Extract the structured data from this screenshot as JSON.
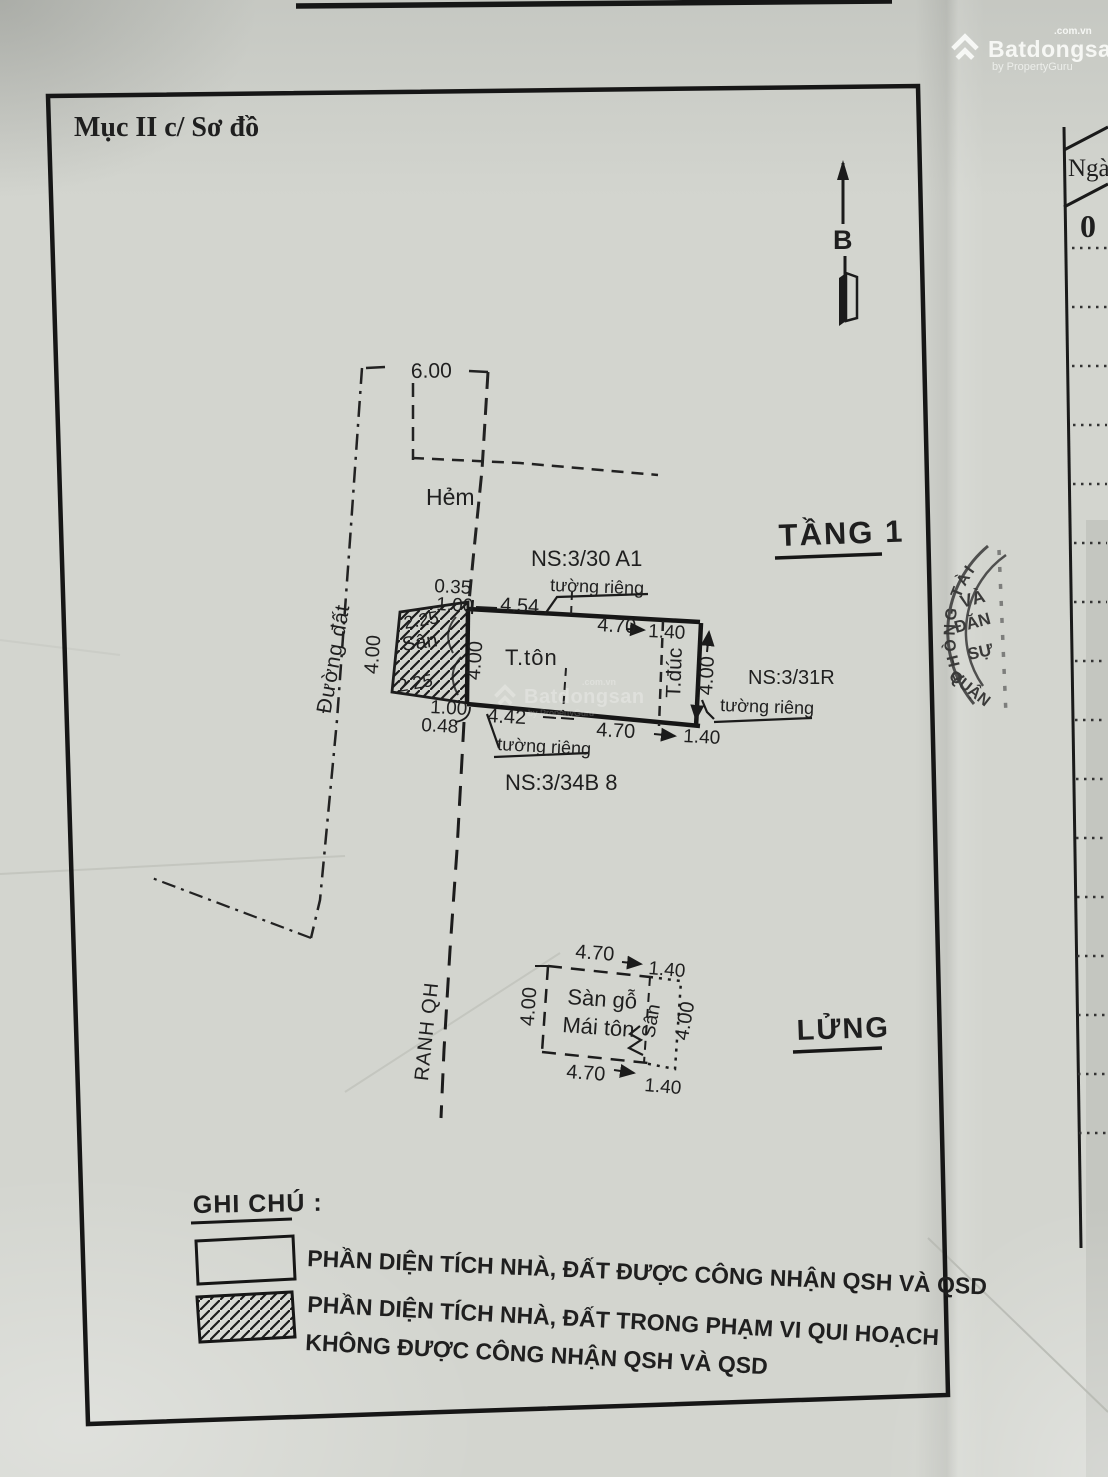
{
  "document": {
    "section_title": "Mục II c/ Sơ đồ"
  },
  "brand": {
    "name": "Batdongsan",
    "tld": ".com.vn",
    "byline": "by PropertyGuru"
  },
  "side_table": {
    "header": "Ngà",
    "digit": "0"
  },
  "compass": {
    "north": "B"
  },
  "floor1": {
    "title": "TẦNG 1",
    "alley": "Hẻm",
    "alley_width": "6.00",
    "road": "Đường đất",
    "boundary": "RANH QH",
    "neighbors": {
      "top": "NS:3/30 A1",
      "right": "NS:3/31R",
      "bottom": "NS:3/34B 8"
    },
    "walls": {
      "top": "tường riêng",
      "right": "tường riêng",
      "bottom": "tường riêng"
    },
    "rooms": {
      "main": "T.tôn",
      "right": "T.đúc",
      "yard": "Sân"
    },
    "dims": {
      "off_top1": "0.35",
      "off_top2": "1.00",
      "top1": "4.54",
      "top2": "4.70",
      "top3": "1.40",
      "left": "4.00",
      "inner_left": "4.00",
      "right": "4.00",
      "yard_top": "2.25",
      "yard_bottom": "2.25",
      "off_bot1": "1.00",
      "off_bot2": "0.48",
      "bot1": "4.42",
      "bot2": "4.70",
      "bot3": "1.40"
    }
  },
  "mezzanine": {
    "title": "LỬNG",
    "room_line1": "Sàn gỗ",
    "room_line2": "Mái tôn",
    "yard": "Sân",
    "dims": {
      "top1": "4.70",
      "top2": "1.40",
      "bot1": "4.70",
      "bot2": "1.40",
      "left": "4.00",
      "right": "4.00"
    }
  },
  "legend": {
    "title": "GHI CHÚ :",
    "item1": "PHẦN DIỆN TÍCH NHÀ, ĐẤT  ĐƯỢC CÔNG NHẬN QSH VÀ QSD",
    "item2_line1": "PHẦN DIỆN TÍCH NHÀ, ĐẤT  TRONG PHẠM VI QUI HOẠCH",
    "item2_line2": "KHÔNG ĐƯỢC CÔNG NHẬN QSH VÀ QSD"
  },
  "stamp": {
    "rim": "PHÒNG TÀI",
    "line1": "VÀ",
    "line2": "ĐĂN",
    "line3": "SỰ",
    "line4": "QUẬN"
  }
}
